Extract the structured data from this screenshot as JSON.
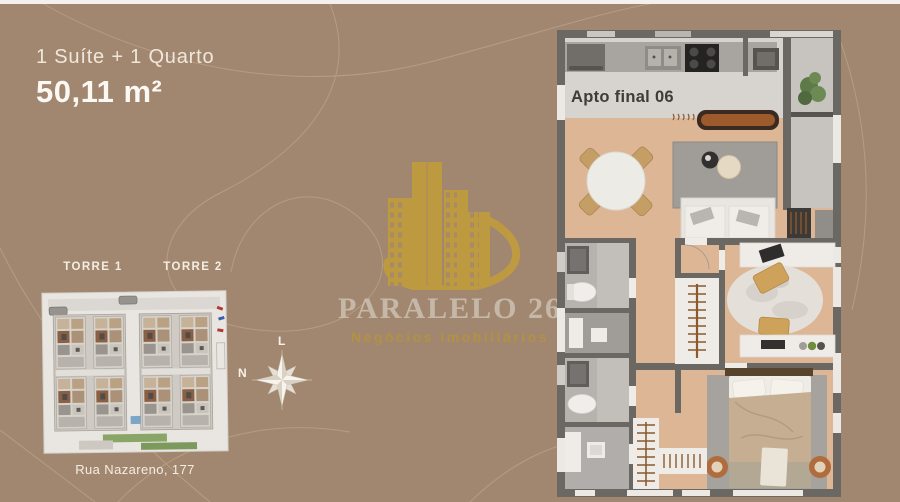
{
  "header": {
    "subtitle": "1 Suíte + 1 Quarto",
    "area": "50,11 m²"
  },
  "logo": {
    "name": "PARALELO 26",
    "tagline": "Negócios Imobiliários"
  },
  "site_plan": {
    "tower1_label": "TORRE 1",
    "tower2_label": "TORRE 2",
    "address": "Rua Nazareno, 177"
  },
  "compass": {
    "east_label": "L",
    "north_label": "N"
  },
  "floor_plan": {
    "unit_label": "Apto final 06"
  },
  "colors": {
    "background": "#a28770",
    "brand_gold": "#c59f35",
    "logo_text": "#cfc4b5",
    "wall": "#6b6763",
    "wood_floor": "#dcb695",
    "kitchen_tile": "#d7d4d0",
    "bath_tile": "#b6b3af",
    "balcony_concrete": "#c7c4bf",
    "rug_gray": "#a09c97",
    "furniture_tan": "#cfa25b",
    "terracotta": "#b06c3c",
    "plant_green": "#5d7a48",
    "white_fixture": "#efece8"
  }
}
